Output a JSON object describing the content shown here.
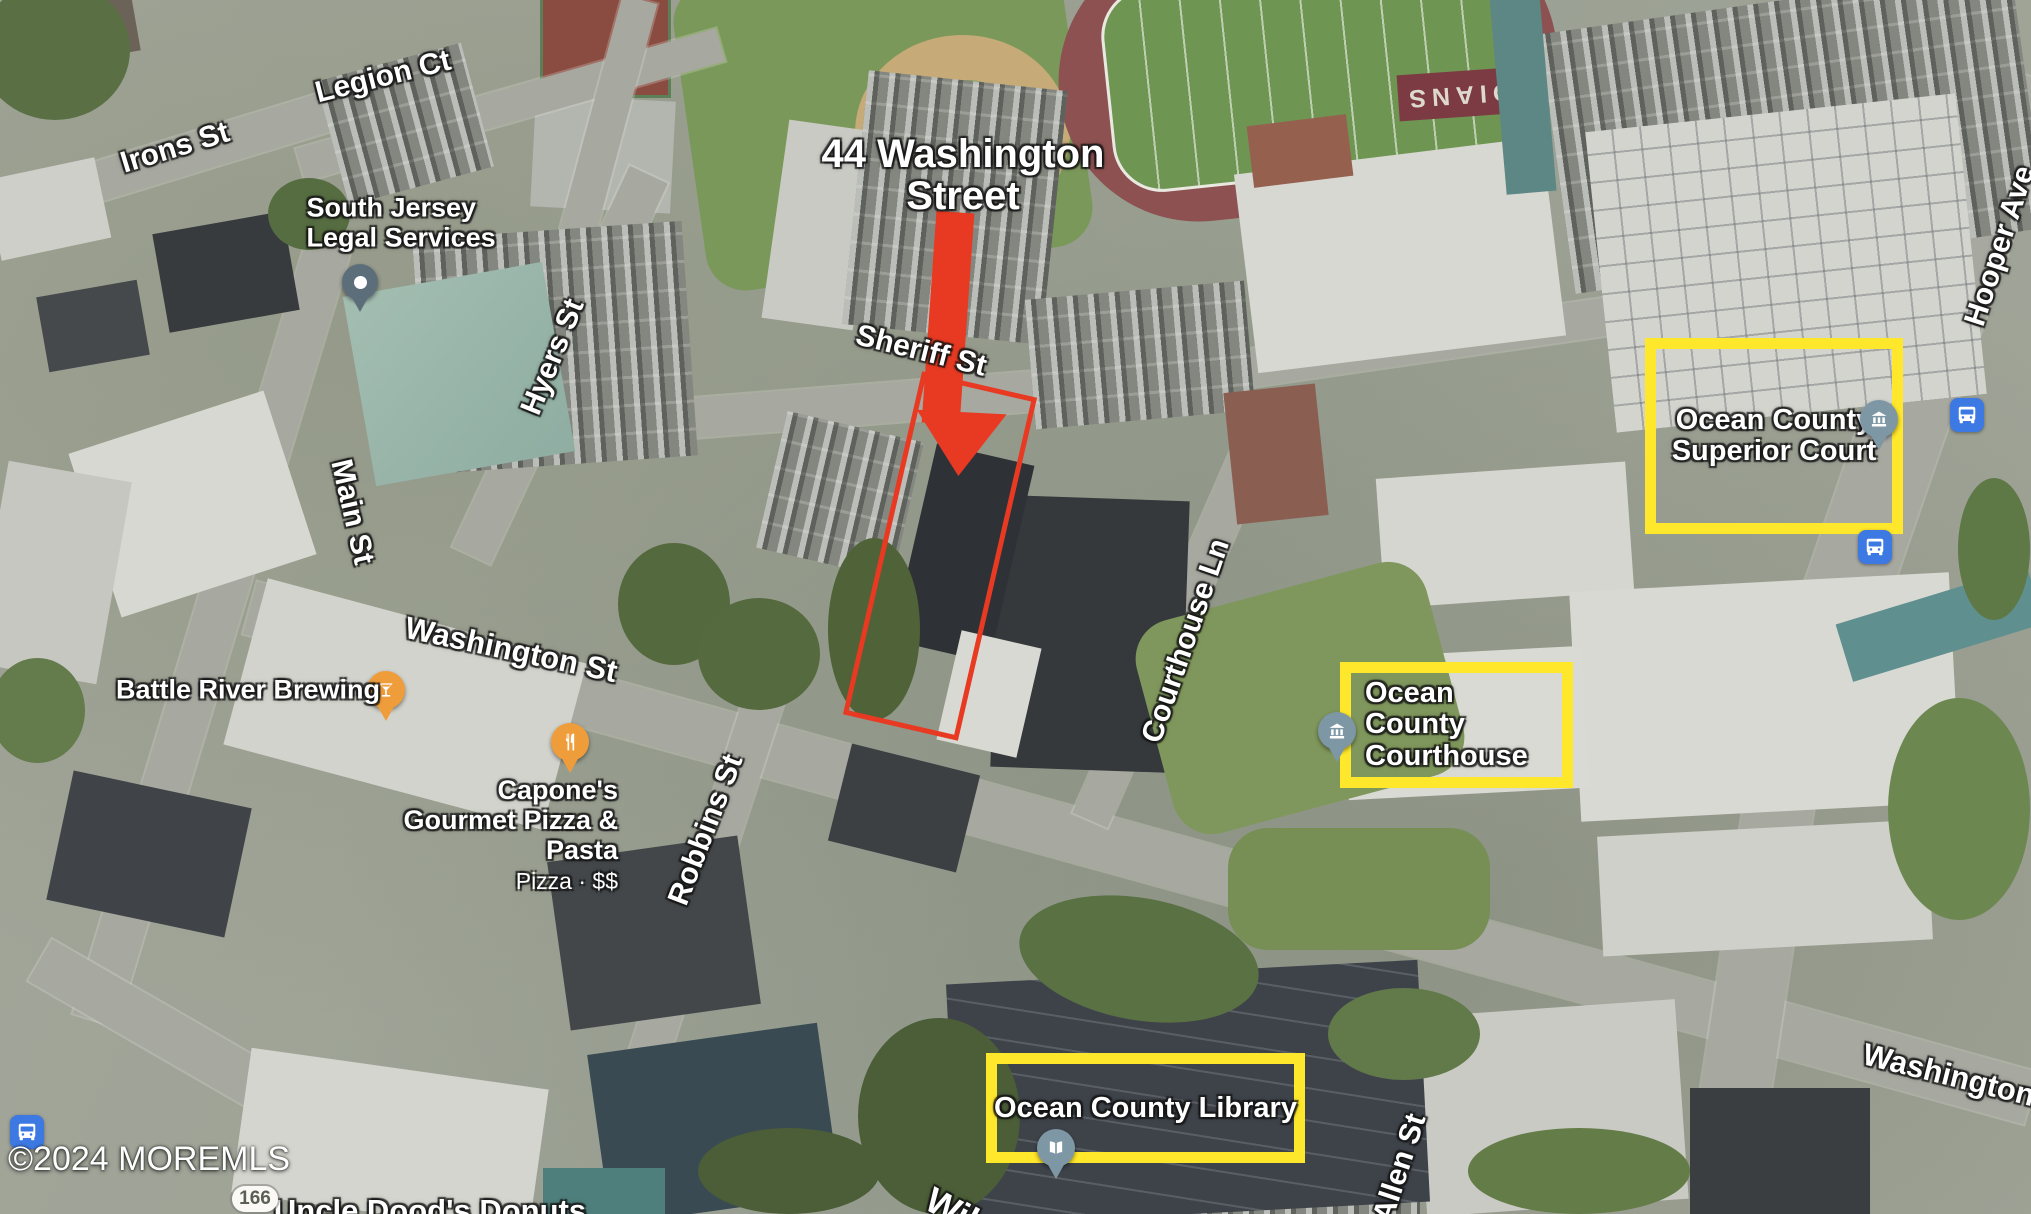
{
  "attribution": "©2024 MOREMLS",
  "route_badge": "166",
  "stadium_text": "INDIANS",
  "annotations": {
    "subject_label": "44 Washington Street",
    "highlight_boxes": [
      {
        "label": "Ocean County Superior Court"
      },
      {
        "label": "Ocean County Courthouse"
      },
      {
        "label": "Ocean County Library"
      }
    ],
    "colors": {
      "highlight_yellow": "#ffe72b",
      "subject_red": "#e83a22",
      "poi_orange": "#ef9d3b",
      "transit_blue": "#3d79e2"
    }
  },
  "streets": [
    {
      "label": "Irons St"
    },
    {
      "label": "Legion Ct"
    },
    {
      "label": "Hyers St"
    },
    {
      "label": "Main St"
    },
    {
      "label": "Sheriff St"
    },
    {
      "label": "Washington St"
    },
    {
      "label": "Courthouse Ln"
    },
    {
      "label": "Robbins St"
    },
    {
      "label": "Hooper Ave"
    },
    {
      "label": "Washington St"
    },
    {
      "label": "Allen St"
    },
    {
      "label": "Wil"
    }
  ],
  "pois": [
    {
      "name": "South Jersey Legal Services"
    },
    {
      "name": "Battle River Brewing"
    },
    {
      "name": "Capone's Gourmet Pizza & Pasta",
      "detail": "Pizza · $$"
    },
    {
      "name": "Uncle Dood's Donuts"
    }
  ]
}
